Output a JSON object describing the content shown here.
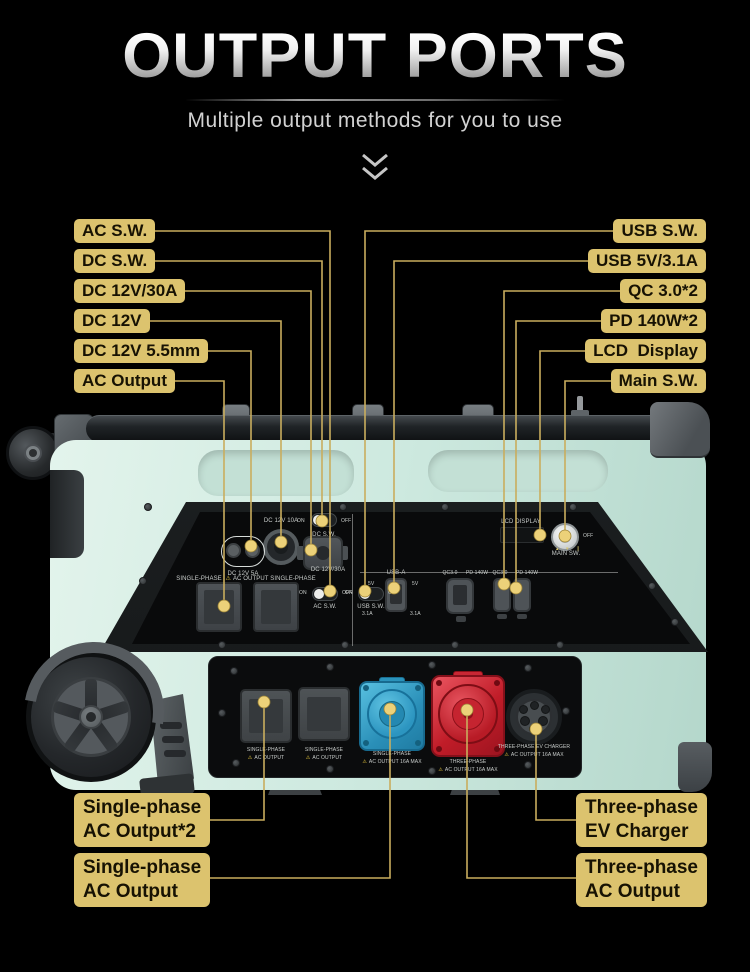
{
  "header": {
    "title": "OUTPUT PORTS",
    "subtitle": "Multiple output methods for you to use"
  },
  "callouts": {
    "left": [
      {
        "label": "AC S.W."
      },
      {
        "label": "DC S.W."
      },
      {
        "label": "DC 12V/30A"
      },
      {
        "label": "DC 12V"
      },
      {
        "label": "DC 12V 5.5mm"
      },
      {
        "label": "AC Output"
      }
    ],
    "right": [
      {
        "label": "USB S.W."
      },
      {
        "label": "USB 5V/3.1A"
      },
      {
        "label": "QC 3.0*2"
      },
      {
        "label": "PD 140W*2"
      },
      {
        "label": "LCD  Display"
      },
      {
        "label": "Main S.W."
      }
    ],
    "bottom_left": [
      {
        "line1": "Single-phase",
        "line2": "AC Output*2"
      },
      {
        "line1": "Single-phase",
        "line2": "AC Output"
      }
    ],
    "bottom_right": [
      {
        "line1": "Three-phase",
        "line2": "EV Charger"
      },
      {
        "line1": "Three-phase",
        "line2": "AC Output"
      }
    ]
  },
  "device_panel": {
    "dc_12v_10a": "DC 12V 10A",
    "dc_12v_5a": "DC 12V 5A",
    "dc_sw": "DC S.W.",
    "dc_12v_30a": "DC 12V/30A",
    "on": "ON",
    "off": "OFF",
    "single_phase": "SINGLE-PHASE",
    "warn": "⚠",
    "ac_output": "AC OUTPUT",
    "ac_sw": "AC S.W.",
    "usb_sw": "USB S.W.",
    "usb_a": "USB-A",
    "usb_5v": "5V",
    "usb_31a": "3.1A",
    "qc30": "QC3.0",
    "pd140": "PD 140W",
    "lcd_display": "LCD DISPLAY",
    "main_sw": "MAIN SW.",
    "three_phase": "THREE-PHASE",
    "ac_out_16a": "AC OUTPUT 16A MAX",
    "ev_charger": "THREE-PHASE EV CHARGER"
  },
  "colors": {
    "background": "#000000",
    "callout_fill": "#dcc36e",
    "leader_line": "#c9ad5e",
    "body_mint": "#cdeae0",
    "socket_blue": "#2f9ec6",
    "socket_red": "#cf2430"
  }
}
